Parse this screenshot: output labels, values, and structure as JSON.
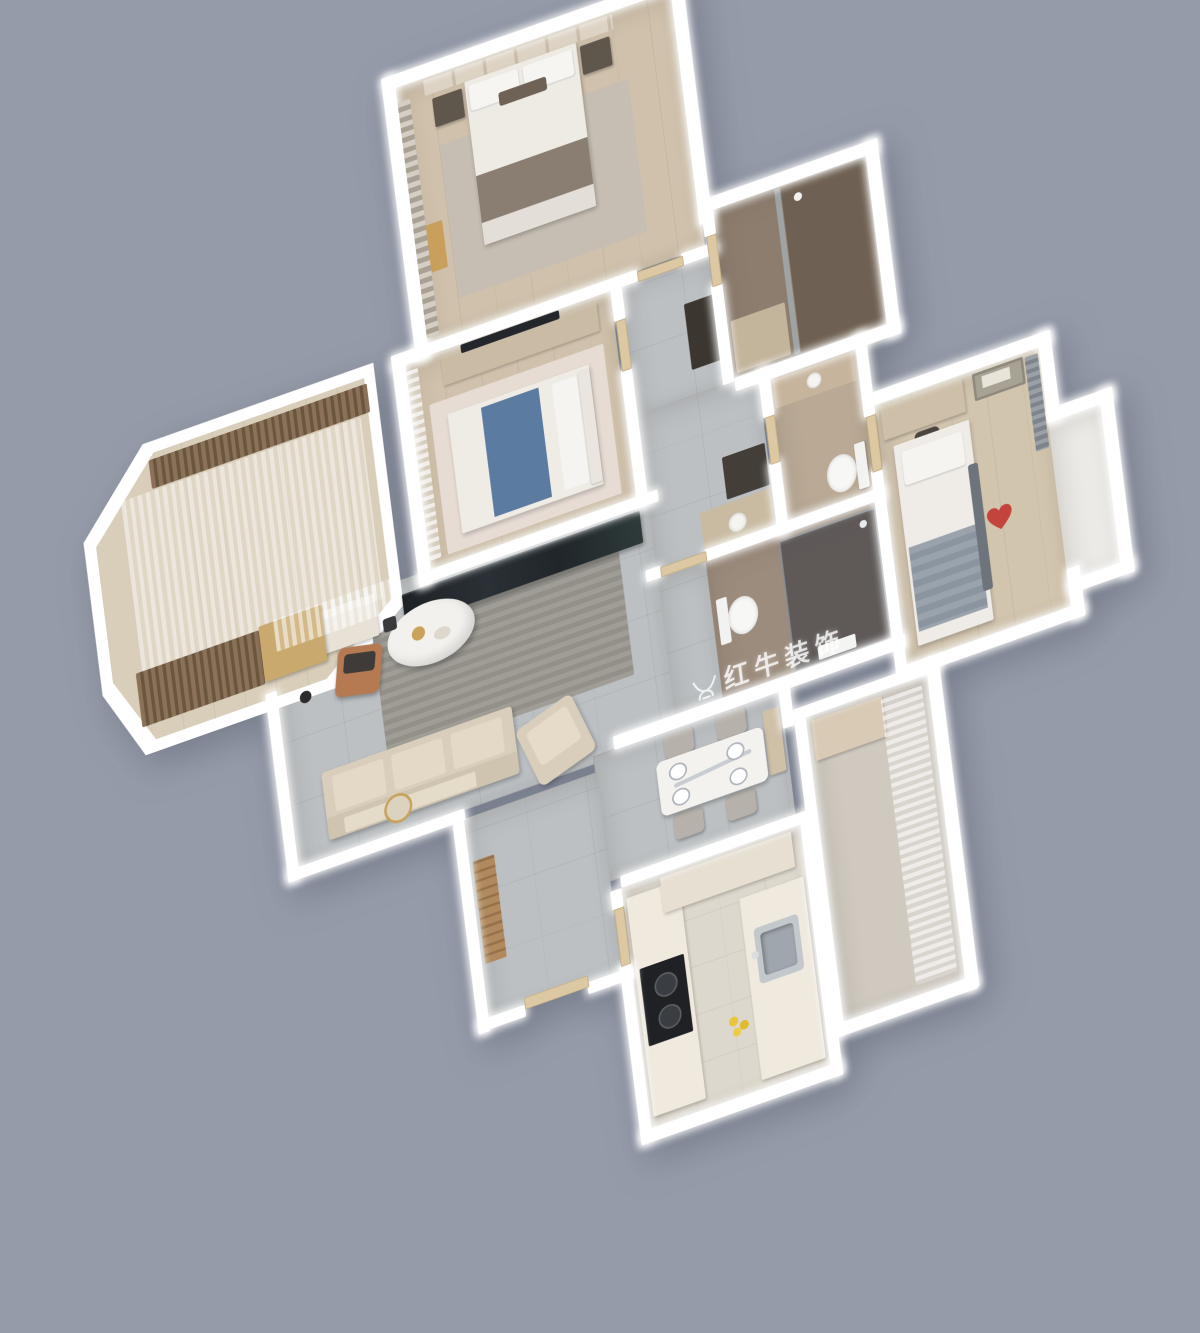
{
  "scene": {
    "type": "3d-isometric-apartment-floor-plan-render",
    "background_color": "#959BA9",
    "wall_color": "#FFFFFF",
    "palette": {
      "wood_floor": "#CFC1AB",
      "tile_floor": "#BCC0C3",
      "master_bath_tile": "#8D7D6E",
      "shower_bath_tile": "#9C8C7D",
      "kitchen_floor": "#DDD8CD",
      "accent_blue_blanket": "#5C7BA0",
      "accent_heart_red": "#C2443C",
      "accent_leather_chair": "#B57A52",
      "accent_gold": "#C9A25C",
      "dark_tv_console": "#22262A"
    }
  },
  "watermark": {
    "logo": "bull-logo",
    "text": "红牛装饰",
    "subtext": "HONG NIU ZHUANG SHI",
    "color": "rgba(255,255,255,0.8)"
  },
  "rooms": [
    {
      "name": "master-bedroom",
      "furniture": [
        "double-bed",
        "pillows",
        "brown-throw-blanket",
        "headboard-panel-wall",
        "nightstand-left",
        "nightstand-right",
        "area-rug",
        "window-curtains",
        "gold-bench"
      ]
    },
    {
      "name": "master-bathroom",
      "furniture": [
        "walk-in-shower",
        "glass-partition",
        "shower-head",
        "door"
      ]
    },
    {
      "name": "second-bedroom",
      "furniture": [
        "double-bed",
        "blue-throw-blanket",
        "headboard",
        "tv-cabinet",
        "wall-tv",
        "window-curtains",
        "area-rug",
        "door"
      ]
    },
    {
      "name": "hallway",
      "furniture": [
        "storage-cabinet",
        "laundry-cabinet",
        "vanity-counter",
        "wash-basin"
      ]
    },
    {
      "name": "guest-bathroom",
      "furniture": [
        "vanity-counter",
        "wash-basin",
        "toilet",
        "door"
      ]
    },
    {
      "name": "shower-bathroom",
      "furniture": [
        "toilet",
        "dark-glass-shower-enclosure",
        "water-heater",
        "door"
      ]
    },
    {
      "name": "kids-bedroom",
      "furniture": [
        "single-bed",
        "striped-gray-blanket",
        "heart-pillow",
        "desk",
        "desk-chair",
        "wall-art",
        "gray-curtains",
        "door"
      ]
    },
    {
      "name": "bay-window",
      "furniture": []
    },
    {
      "name": "living-room",
      "furniture": [
        "sofa",
        "back-cushions",
        "oval-coffee-table",
        "dark-marble-tv-console",
        "striped-rug",
        "desk",
        "leather-desk-chair",
        "floor-lamp",
        "dark-vase",
        "armchair",
        "console-table",
        "gold-round-mirror",
        "sheer-curtain"
      ]
    },
    {
      "name": "dining-room",
      "furniture": [
        "marble-dining-table",
        "dining-chair-1",
        "dining-chair-2",
        "dining-chair-3",
        "dining-chair-4",
        "place-settings",
        "sideboard"
      ]
    },
    {
      "name": "entry-hall",
      "furniture": [
        "wood-shoe-bench",
        "entry-door"
      ]
    },
    {
      "name": "kitchen",
      "furniture": [
        "l-shaped-counter",
        "gas-cooktop",
        "stainless-sink",
        "upper-cabinets",
        "lemons"
      ]
    },
    {
      "name": "left-balcony",
      "furniture": [
        "brown-roller-blinds",
        "sheer-curtain",
        "wood-cabinet"
      ]
    },
    {
      "name": "right-balcony",
      "furniture": [
        "storage-cabinet",
        "sheer-curtains"
      ]
    }
  ]
}
